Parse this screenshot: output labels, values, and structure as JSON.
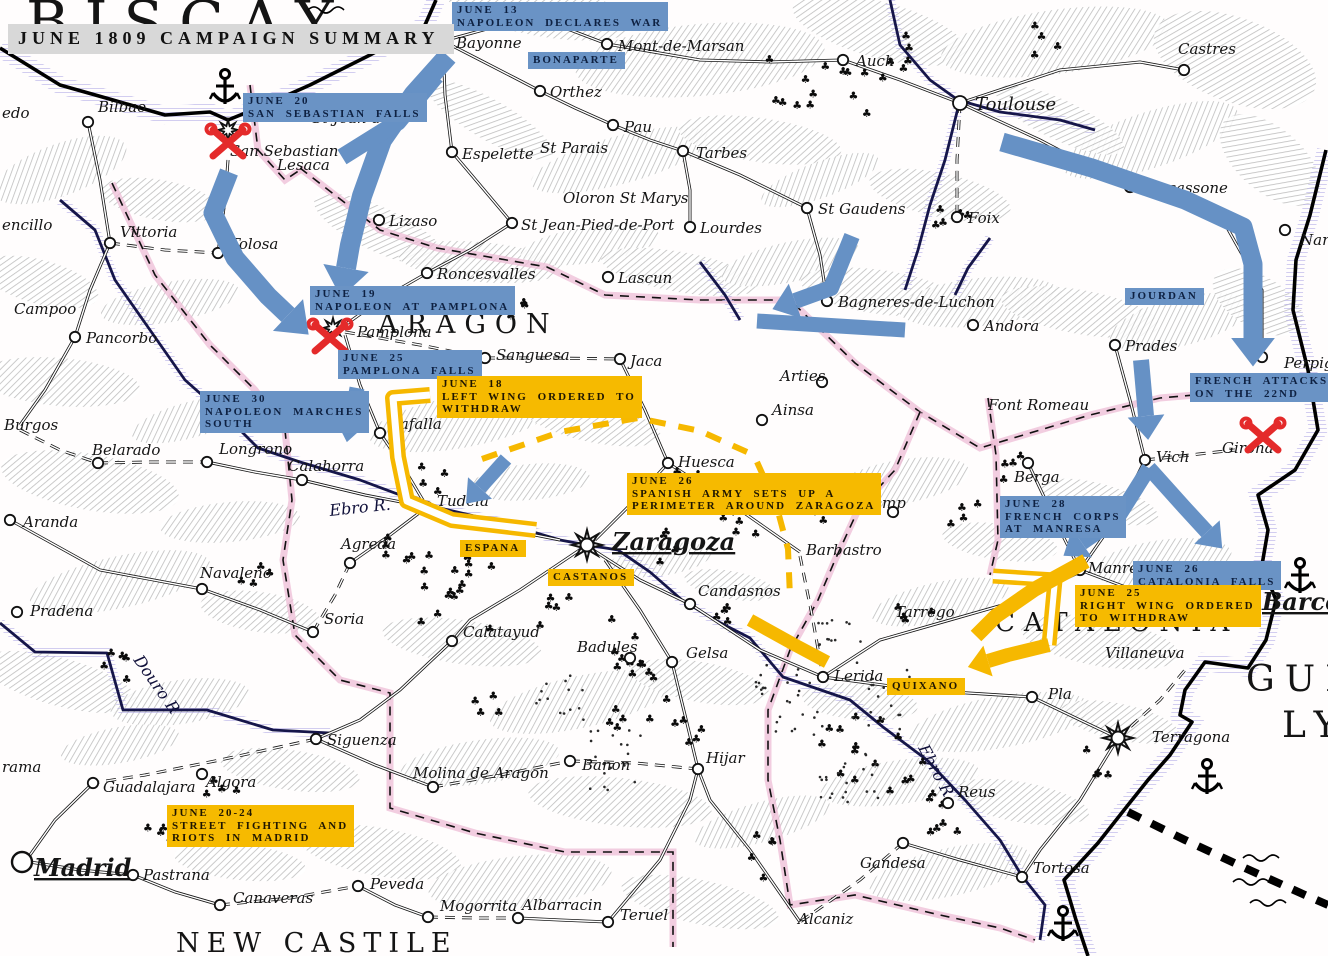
{
  "title": {
    "box": "JUNE 1809 CAMPAIGN SUMMARY"
  },
  "palette": {
    "french": "#6691c5",
    "spanish": "#f6b800",
    "battle": "#e42a2a",
    "river": "#16164a",
    "coast": "#000000",
    "pink_border": "#eebcd6",
    "lilac": "#b7b0e8",
    "label_gray": "#d8d8d8"
  },
  "regions": [
    {
      "name": "BISCAY",
      "x": 26,
      "y": 42,
      "size": 58,
      "ls": 16
    },
    {
      "name": "ARAGON",
      "x": 378,
      "y": 333,
      "size": 27,
      "ls": 9
    },
    {
      "name": "NEW CASTILE",
      "x": 176,
      "y": 952,
      "size": 27,
      "ls": 7
    },
    {
      "name": "CATALONIA",
      "x": 995,
      "y": 631,
      "size": 26,
      "ls": 9
    },
    {
      "name": "GUL",
      "x": 1246,
      "y": 691,
      "size": 36,
      "ls": 10
    },
    {
      "name": "LY",
      "x": 1282,
      "y": 737,
      "size": 36,
      "ls": 10
    }
  ],
  "rivers": [
    {
      "name": "Ebro R.",
      "x": 330,
      "y": 516,
      "rot": -6
    },
    {
      "name": "Ebro R",
      "x": 918,
      "y": 748,
      "rot": 62
    },
    {
      "name": "Douro R",
      "x": 133,
      "y": 660,
      "rot": 55
    }
  ],
  "cities": [
    {
      "name": "Bayonne",
      "mx": 443,
      "my": 41,
      "lx": 456,
      "ly": 48
    },
    {
      "name": "Mont-de-Marsan",
      "mx": 607,
      "my": 44,
      "lx": 618,
      "ly": 51
    },
    {
      "name": "Orthez",
      "mx": 540,
      "my": 91,
      "lx": 550,
      "ly": 97
    },
    {
      "name": "Espelette",
      "mx": 452,
      "my": 152,
      "lx": 462,
      "ly": 159
    },
    {
      "name": "St Parais",
      "lx": 540,
      "ly": 153
    },
    {
      "name": "Pau",
      "mx": 613,
      "my": 125,
      "lx": 624,
      "ly": 132
    },
    {
      "name": "Tarbes",
      "mx": 683,
      "my": 151,
      "lx": 696,
      "ly": 158
    },
    {
      "name": "Oloron St Marys",
      "lx": 563,
      "ly": 203
    },
    {
      "name": "St Jean-Pied-de-Port",
      "mx": 512,
      "my": 223,
      "lx": 521,
      "ly": 230
    },
    {
      "name": "Lourdes",
      "mx": 690,
      "my": 227,
      "lx": 700,
      "ly": 233
    },
    {
      "name": "Lascun",
      "mx": 608,
      "my": 277,
      "lx": 618,
      "ly": 283
    },
    {
      "name": "Roncesvalles",
      "mx": 427,
      "my": 273,
      "lx": 437,
      "ly": 279
    },
    {
      "name": "Lizaso",
      "mx": 379,
      "my": 220,
      "lx": 389,
      "ly": 226
    },
    {
      "name": "Toulouse",
      "mx": 960,
      "my": 103,
      "lx": 975,
      "ly": 110,
      "fs": 18,
      "big": true
    },
    {
      "name": "Auch",
      "mx": 843,
      "my": 60,
      "lx": 856,
      "ly": 66
    },
    {
      "name": "Castres",
      "mx": 1184,
      "my": 70,
      "lx": 1178,
      "ly": 54
    },
    {
      "name": "Carcassone",
      "mx": 1130,
      "my": 187,
      "lx": 1140,
      "ly": 193
    },
    {
      "name": "St Gaudens",
      "mx": 807,
      "my": 208,
      "lx": 818,
      "ly": 214
    },
    {
      "name": "Foix",
      "mx": 957,
      "my": 217,
      "lx": 968,
      "ly": 223
    },
    {
      "name": "Bagneres-de-Luchon",
      "mx": 827,
      "my": 301,
      "lx": 838,
      "ly": 307
    },
    {
      "name": "Andora",
      "mx": 973,
      "my": 325,
      "lx": 984,
      "ly": 331
    },
    {
      "name": "Prades",
      "mx": 1115,
      "my": 345,
      "lx": 1125,
      "ly": 351
    },
    {
      "name": "Font Romeau",
      "lx": 988,
      "ly": 410
    },
    {
      "name": "Perpig",
      "mx": 1262,
      "my": 357,
      "lx": 1284,
      "ly": 368
    },
    {
      "name": "Nar",
      "mx": 1285,
      "my": 230,
      "lx": 1300,
      "ly": 245
    },
    {
      "name": "Bilbao",
      "mx": 88,
      "my": 122,
      "lx": 98,
      "ly": 112
    },
    {
      "name": "edo",
      "lx": 2,
      "ly": 118
    },
    {
      "name": "San Sebastian",
      "mx": 228,
      "my": 130,
      "lx": 230,
      "ly": 156,
      "fort": true
    },
    {
      "name": "Lesaca",
      "lx": 277,
      "ly": 170
    },
    {
      "name": "St Jean-de-L",
      "lx": 312,
      "ly": 123
    },
    {
      "name": "Vittoria",
      "mx": 110,
      "my": 243,
      "lx": 120,
      "ly": 237
    },
    {
      "name": "Tolosa",
      "mx": 218,
      "my": 253,
      "lx": 230,
      "ly": 249
    },
    {
      "name": "encillo",
      "lx": 2,
      "ly": 230
    },
    {
      "name": "Campoo",
      "lx": 14,
      "ly": 314
    },
    {
      "name": "Pancorbo",
      "mx": 75,
      "my": 337,
      "lx": 86,
      "ly": 343
    },
    {
      "name": "Burgos",
      "lx": 4,
      "ly": 430
    },
    {
      "name": "Belarado",
      "mx": 98,
      "my": 463,
      "lx": 92,
      "ly": 455
    },
    {
      "name": "Longrono",
      "mx": 207,
      "my": 462,
      "lx": 219,
      "ly": 454
    },
    {
      "name": "Calahorra",
      "mx": 302,
      "my": 480,
      "lx": 288,
      "ly": 471
    },
    {
      "name": "Aranda",
      "mx": 10,
      "my": 520,
      "lx": 23,
      "ly": 527
    },
    {
      "name": "Agreda",
      "mx": 350,
      "my": 563,
      "lx": 341,
      "ly": 549
    },
    {
      "name": "Navaleno",
      "mx": 202,
      "my": 589,
      "lx": 200,
      "ly": 578
    },
    {
      "name": "Pradena",
      "mx": 17,
      "my": 612,
      "lx": 30,
      "ly": 616
    },
    {
      "name": "Soria",
      "mx": 313,
      "my": 632,
      "lx": 324,
      "ly": 624
    },
    {
      "name": "Madrid",
      "mx": 22,
      "my": 862,
      "lx": 34,
      "ly": 876,
      "major": true
    },
    {
      "name": "Guadalajara",
      "mx": 93,
      "my": 783,
      "lx": 103,
      "ly": 792
    },
    {
      "name": "Algora",
      "mx": 202,
      "my": 774,
      "lx": 206,
      "ly": 787
    },
    {
      "name": "Pastrana",
      "mx": 133,
      "my": 875,
      "lx": 143,
      "ly": 880
    },
    {
      "name": "Canaveras",
      "mx": 220,
      "my": 905,
      "lx": 233,
      "ly": 903
    },
    {
      "name": "Peveda",
      "mx": 358,
      "my": 886,
      "lx": 370,
      "ly": 889
    },
    {
      "name": "Siguenza",
      "mx": 316,
      "my": 739,
      "lx": 327,
      "ly": 745
    },
    {
      "name": "Molina de Aragon",
      "mx": 433,
      "my": 787,
      "lx": 413,
      "ly": 778
    },
    {
      "name": "Banon",
      "mx": 570,
      "my": 761,
      "lx": 582,
      "ly": 770
    },
    {
      "name": "Hijar",
      "mx": 698,
      "my": 769,
      "lx": 706,
      "ly": 763
    },
    {
      "name": "Mogorrita",
      "mx": 428,
      "my": 917,
      "lx": 440,
      "ly": 911
    },
    {
      "name": "Albarracin",
      "mx": 518,
      "my": 918,
      "lx": 522,
      "ly": 910
    },
    {
      "name": "Teruel",
      "mx": 608,
      "my": 922,
      "lx": 620,
      "ly": 920
    },
    {
      "name": "Calatayud",
      "mx": 452,
      "my": 641,
      "lx": 463,
      "ly": 637
    },
    {
      "name": "Badules",
      "mx": 630,
      "my": 658,
      "lx": 577,
      "ly": 652
    },
    {
      "name": "Gelsa",
      "mx": 672,
      "my": 662,
      "lx": 686,
      "ly": 658
    },
    {
      "name": "rama",
      "lx": 2,
      "ly": 772
    },
    {
      "name": "Pamplona",
      "mx": 333,
      "my": 328,
      "lx": 357,
      "ly": 337,
      "fort": true
    },
    {
      "name": "Tafalla",
      "mx": 380,
      "my": 433,
      "lx": 391,
      "ly": 429
    },
    {
      "name": "Sanguesa",
      "mx": 485,
      "my": 358,
      "lx": 496,
      "ly": 360
    },
    {
      "name": "Jaca",
      "mx": 620,
      "my": 359,
      "lx": 630,
      "ly": 366
    },
    {
      "name": "Arties",
      "mx": 822,
      "my": 382,
      "lx": 780,
      "ly": 381
    },
    {
      "name": "Ainsa",
      "mx": 762,
      "my": 420,
      "lx": 772,
      "ly": 415
    },
    {
      "name": "Tudela",
      "mx": 427,
      "my": 507,
      "lx": 437,
      "ly": 506
    },
    {
      "name": "Huesca",
      "mx": 668,
      "my": 463,
      "lx": 678,
      "ly": 467
    },
    {
      "name": "Barbastro",
      "lx": 806,
      "ly": 555
    },
    {
      "name": "Candasnos",
      "mx": 690,
      "my": 604,
      "lx": 698,
      "ly": 596
    },
    {
      "name": "Tremp",
      "mx": 893,
      "my": 512,
      "lx": 856,
      "ly": 508
    },
    {
      "name": "Zaragoza",
      "mx": 587,
      "my": 545,
      "lx": 612,
      "ly": 550,
      "major": true,
      "star": true
    },
    {
      "name": "Berga",
      "mx": 1028,
      "my": 463,
      "lx": 1014,
      "ly": 482
    },
    {
      "name": "Vich",
      "mx": 1145,
      "my": 460,
      "lx": 1156,
      "ly": 462
    },
    {
      "name": "Girona",
      "lx": 1222,
      "ly": 453
    },
    {
      "name": "Manresa",
      "mx": 1080,
      "my": 570,
      "lx": 1088,
      "ly": 573
    },
    {
      "name": "Barcel",
      "lx": 1262,
      "ly": 610,
      "major": true
    },
    {
      "name": "Villaneuva",
      "lx": 1105,
      "ly": 658
    },
    {
      "name": "Pla",
      "mx": 1032,
      "my": 697,
      "lx": 1048,
      "ly": 699
    },
    {
      "name": "Terragona",
      "mx": 1118,
      "my": 738,
      "lx": 1152,
      "ly": 742,
      "star": true
    },
    {
      "name": "Reus",
      "mx": 948,
      "my": 803,
      "lx": 958,
      "ly": 797
    },
    {
      "name": "Gandesa",
      "mx": 903,
      "my": 843,
      "lx": 860,
      "ly": 868
    },
    {
      "name": "Tortosa",
      "mx": 1022,
      "my": 877,
      "lx": 1033,
      "ly": 873
    },
    {
      "name": "Alcaniz",
      "lx": 798,
      "ly": 924
    },
    {
      "name": "Lerida",
      "mx": 823,
      "my": 677,
      "lx": 834,
      "ly": 681
    },
    {
      "name": "Tarrego",
      "lx": 895,
      "ly": 617
    }
  ],
  "battles": [
    {
      "name": "san-sebastian",
      "x": 228,
      "y": 143
    },
    {
      "name": "pamplona",
      "x": 330,
      "y": 338
    },
    {
      "name": "girona",
      "x": 1263,
      "y": 437
    }
  ],
  "decor": {
    "anchors": [
      {
        "x": 225,
        "y": 88
      },
      {
        "x": 1300,
        "y": 577
      },
      {
        "x": 1207,
        "y": 778
      },
      {
        "x": 1063,
        "y": 925
      }
    ],
    "waves": [
      {
        "x": 308,
        "y": 10
      },
      {
        "x": 1243,
        "y": 858
      },
      {
        "x": 1233,
        "y": 882
      },
      {
        "x": 1250,
        "y": 903
      }
    ]
  },
  "events": [
    {
      "id": "june13-declares-war",
      "side": "french",
      "x": 452,
      "y": 2,
      "lines": [
        "JUNE 13",
        "NAPOLEON DECLARES WAR"
      ]
    },
    {
      "id": "bonaparte",
      "side": "french",
      "x": 528,
      "y": 52,
      "lines": [
        "BONAPARTE"
      ]
    },
    {
      "id": "june20-san-sebastian-falls",
      "side": "french",
      "x": 243,
      "y": 93,
      "lines": [
        "JUNE 20",
        "SAN SEBASTIAN FALLS"
      ]
    },
    {
      "id": "june19-napoleon-at-pamplona",
      "side": "french",
      "x": 310,
      "y": 286,
      "lines": [
        "JUNE 19",
        "NAPOLEON AT PAMPLONA"
      ]
    },
    {
      "id": "june25-pamplona-falls",
      "side": "french",
      "x": 338,
      "y": 350,
      "lines": [
        "JUNE 25",
        "PAMPLONA FALLS"
      ]
    },
    {
      "id": "june30-marches-south",
      "side": "french",
      "x": 200,
      "y": 391,
      "lines": [
        "JUNE 30",
        "NAPOLEON MARCHES",
        "SOUTH"
      ]
    },
    {
      "id": "jourdan",
      "side": "french",
      "x": 1125,
      "y": 288,
      "lines": [
        "JOURDAN"
      ]
    },
    {
      "id": "french-attacks-22nd",
      "side": "french",
      "x": 1190,
      "y": 373,
      "lines": [
        "FRENCH ATTACKS",
        "ON THE 22ND"
      ]
    },
    {
      "id": "june28-corps-manresa",
      "side": "french",
      "x": 1000,
      "y": 496,
      "lines": [
        "JUNE 28",
        "FRENCH CORPS",
        "AT MANRESA"
      ]
    },
    {
      "id": "june26-catalonia-falls",
      "side": "french",
      "x": 1133,
      "y": 561,
      "lines": [
        "JUNE 26",
        "CATALONIA FALLS"
      ]
    },
    {
      "id": "june18-left-wing",
      "side": "spanish",
      "x": 437,
      "y": 376,
      "lines": [
        "JUNE 18",
        "LEFT WING ORDERED TO",
        "WITHDRAW"
      ]
    },
    {
      "id": "june26-zaragoza-perimeter",
      "side": "spanish",
      "x": 627,
      "y": 473,
      "lines": [
        "JUNE 26",
        "SPANISH ARMY SETS UP A",
        "PERIMETER AROUND ZARAGOZA"
      ]
    },
    {
      "id": "espana",
      "side": "spanish",
      "x": 460,
      "y": 540,
      "lines": [
        "ESPANA"
      ]
    },
    {
      "id": "castanos",
      "side": "spanish",
      "x": 548,
      "y": 569,
      "lines": [
        "CASTANOS"
      ]
    },
    {
      "id": "june25-right-wing",
      "side": "spanish",
      "x": 1075,
      "y": 585,
      "lines": [
        "JUNE 25",
        "RIGHT WING ORDERED",
        "TO WITHDRAW"
      ]
    },
    {
      "id": "quixano",
      "side": "spanish",
      "x": 887,
      "y": 678,
      "lines": [
        "QUIXANO"
      ]
    },
    {
      "id": "june2024-madrid-riots",
      "side": "spanish",
      "x": 167,
      "y": 805,
      "lines": [
        "JUNE 20-24",
        "STREET FIGHTING AND",
        "RIOTS IN MADRID"
      ]
    }
  ],
  "movements": [
    {
      "id": "bayonne-to-pamplona",
      "side": "french",
      "width": 20,
      "head": true,
      "points": [
        [
          448,
          56
        ],
        [
          414,
          94
        ],
        [
          382,
          140
        ],
        [
          362,
          196
        ],
        [
          350,
          245
        ],
        [
          346,
          268
        ]
      ]
    },
    {
      "id": "bayonne-to-san-sebastian",
      "side": "french",
      "width": 17,
      "head": false,
      "points": [
        [
          436,
          76
        ],
        [
          398,
          122
        ],
        [
          342,
          157
        ]
      ]
    },
    {
      "id": "san-sebastian-to-pamplona",
      "side": "french",
      "width": 19,
      "head": true,
      "points": [
        [
          229,
          172
        ],
        [
          213,
          213
        ],
        [
          235,
          258
        ],
        [
          268,
          296
        ],
        [
          288,
          315
        ]
      ]
    },
    {
      "id": "jourdan-to-perpignan",
      "side": "french",
      "width": 19,
      "head": true,
      "points": [
        [
          1002,
          142
        ],
        [
          1092,
          168
        ],
        [
          1185,
          200
        ],
        [
          1243,
          227
        ],
        [
          1253,
          264
        ],
        [
          1253,
          338
        ]
      ]
    },
    {
      "id": "luchon-elbow",
      "side": "french",
      "width": 16,
      "head": true,
      "points": [
        [
          852,
          236
        ],
        [
          831,
          288
        ],
        [
          795,
          301
        ]
      ]
    },
    {
      "id": "luchon-bar",
      "side": "french",
      "width": 15,
      "head": false,
      "points": [
        [
          757,
          321
        ],
        [
          905,
          330
        ]
      ]
    },
    {
      "id": "prades-to-vich",
      "side": "french",
      "width": 16,
      "head": true,
      "points": [
        [
          1141,
          360
        ],
        [
          1146,
          416
        ]
      ]
    },
    {
      "id": "vich-fork-east",
      "side": "french",
      "width": 15,
      "head": true,
      "points": [
        [
          1149,
          468
        ],
        [
          1184,
          507
        ],
        [
          1207,
          532
        ]
      ]
    },
    {
      "id": "vich-fork-west",
      "side": "french",
      "width": 15,
      "head": true,
      "points": [
        [
          1149,
          468
        ],
        [
          1117,
          519
        ],
        [
          1082,
          543
        ]
      ]
    },
    {
      "id": "june30-arrow",
      "side": "french",
      "width": 15,
      "head": true,
      "points": [
        [
          357,
          388
        ],
        [
          351,
          420
        ]
      ]
    },
    {
      "id": "to-tudela",
      "side": "french",
      "width": 14,
      "head": true,
      "points": [
        [
          506,
          459
        ],
        [
          480,
          488
        ]
      ]
    },
    {
      "id": "left-wing-hook",
      "side": "spanish",
      "style": "hollow",
      "width": 16,
      "head": false,
      "points": [
        [
          430,
          395
        ],
        [
          393,
          398
        ],
        [
          398,
          457
        ],
        [
          407,
          501
        ],
        [
          452,
          520
        ],
        [
          536,
          530
        ]
      ]
    },
    {
      "id": "right-wing-corner",
      "side": "spanish",
      "style": "hollow",
      "width": 15,
      "head": false,
      "points": [
        [
          993,
          576
        ],
        [
          1055,
          580
        ],
        [
          1049,
          645
        ]
      ]
    },
    {
      "id": "manresa-swoosh",
      "side": "spanish",
      "width": 15,
      "head": false,
      "points": [
        [
          1086,
          561
        ],
        [
          1035,
          589
        ],
        [
          996,
          616
        ],
        [
          976,
          636
        ]
      ]
    },
    {
      "id": "to-lerida-head",
      "side": "spanish",
      "width": 14,
      "head": true,
      "points": [
        [
          1049,
          645
        ],
        [
          1008,
          655
        ],
        [
          988,
          661
        ]
      ]
    },
    {
      "id": "lerida-diagonal",
      "side": "spanish",
      "width": 13,
      "head": false,
      "points": [
        [
          750,
          620
        ],
        [
          795,
          645
        ],
        [
          827,
          662
        ]
      ]
    },
    {
      "id": "withdraw-route-north",
      "side": "spanish",
      "style": "dashed",
      "width": 6,
      "head": false,
      "points": [
        [
          482,
          459
        ],
        [
          560,
          432
        ],
        [
          638,
          418
        ],
        [
          700,
          431
        ],
        [
          747,
          452
        ]
      ]
    },
    {
      "id": "withdraw-route-east",
      "side": "spanish",
      "style": "dashed",
      "width": 6,
      "head": false,
      "points": [
        [
          757,
          462
        ],
        [
          776,
          504
        ],
        [
          788,
          549
        ],
        [
          790,
          597
        ]
      ]
    }
  ]
}
